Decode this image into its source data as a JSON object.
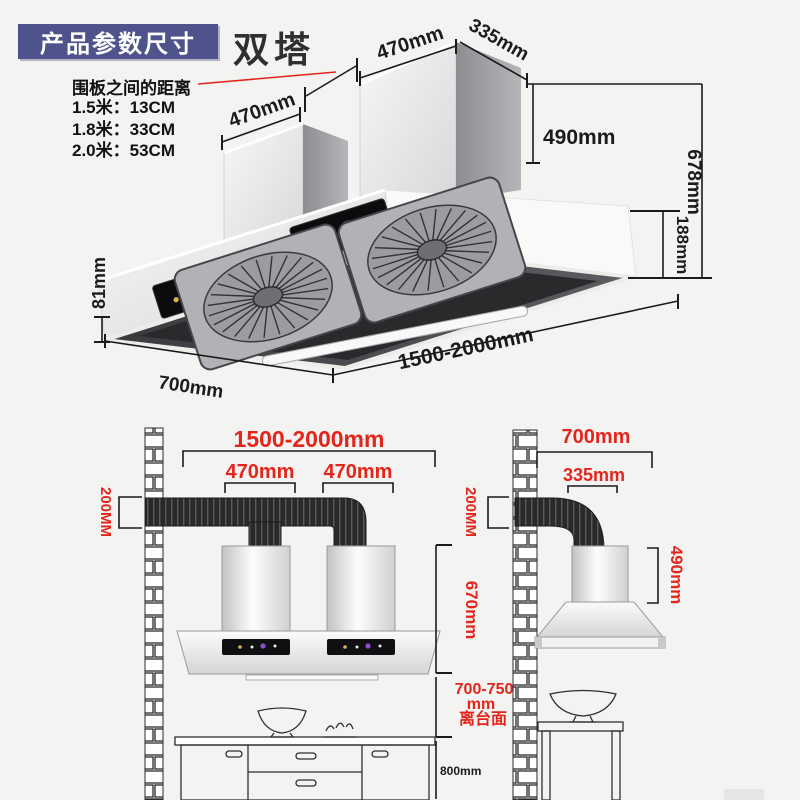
{
  "header": {
    "badge": "产品参数尺寸",
    "model": "双塔"
  },
  "note": {
    "title": "围板之间的距离",
    "rows": [
      "1.5米：13CM",
      "1.8米：33CM",
      "2.0米：53CM"
    ]
  },
  "top_view": {
    "left_chimney_width": "470mm",
    "right_chimney_width": "470mm",
    "chimney_depth": "335mm",
    "chimney_height": "490mm",
    "total_height": "678mm",
    "hood_body_height": "188mm",
    "front_edge_height": "81mm",
    "hood_depth": "700mm",
    "hood_length": "1500-2000mm"
  },
  "front_elevation": {
    "total_width": "1500-2000mm",
    "left_chimney_width": "470mm",
    "right_chimney_width": "470mm",
    "duct_height": "200MM",
    "hood_height": "670mm",
    "clearance_value": "700-750",
    "clearance_unit": "mm",
    "clearance_label": "离台面",
    "counter_height": "800mm"
  },
  "side_elevation": {
    "hood_depth": "700mm",
    "chimney_depth": "335mm",
    "duct_height": "200MM",
    "chimney_height": "490mm"
  },
  "colors": {
    "accent_red": "#e3251c",
    "badge_indigo": "#4e538c",
    "ink": "#1b1b1b"
  }
}
